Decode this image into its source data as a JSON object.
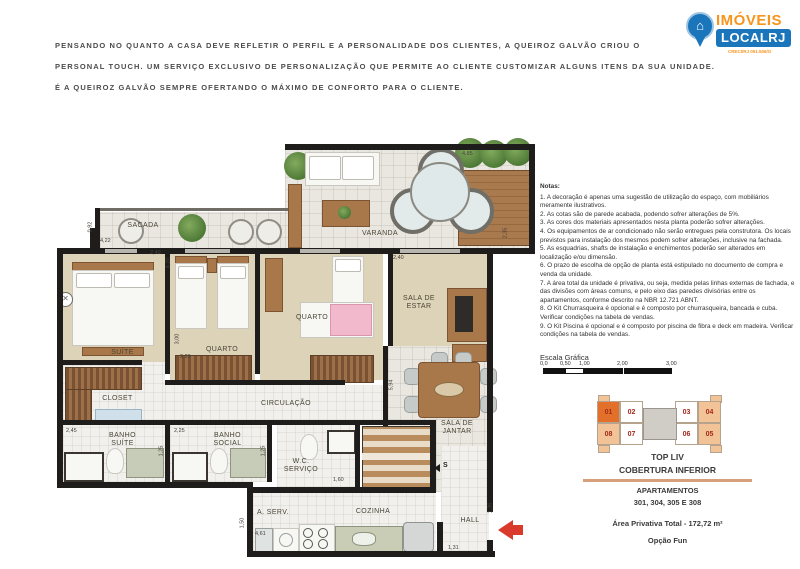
{
  "header": {
    "lines": [
      "PENSANDO NO QUANTO A CASA DEVE REFLETIR O PERFIL E A PERSONALIDADE DOS CLIENTES, A QUEIROZ GALVÃO CRIOU O",
      "PERSONAL TOUCH. UM SERVIÇO EXCLUSIVO DE PERSONALIZAÇÃO QUE PERMITE AO CLIENTE CUSTOMIZAR ALGUNS ITENS DA SUA UNIDADE.",
      "É A QUEIROZ GALVÃO SEMPRE OFERTANDO O MÁXIMO DE CONFORTO PARA O CLIENTE."
    ]
  },
  "logo": {
    "brand_top": "IMÓVEIS",
    "brand_bottom": "LOCALRJ",
    "creci": "CRECI/RJ 051.506/O"
  },
  "colors": {
    "brand_orange": "#F7941E",
    "brand_blue": "#1B75BB",
    "keyplan_highlight": "#E2702A",
    "keyplan_shade": "#F2C396",
    "entry_arrow": "#D93A2B"
  },
  "plan": {
    "rooms": {
      "sacada": "SACADA",
      "varanda": "VARANDA",
      "suite": "SUÍTE",
      "quarto1": "QUARTO",
      "quarto2": "QUARTO",
      "closet": "CLOSET",
      "circulacao": "CIRCULAÇÃO",
      "sala_estar": "SALA DE\nESTAR",
      "sala_jantar": "SALA DE\nJANTAR",
      "banho_suite": "BANHO\nSUÍTE",
      "banho_social": "BANHO\nSOCIAL",
      "wc_servico": "W.C.\nSERVIÇO",
      "a_serv": "A. SERV.",
      "cozinha": "COZINHA",
      "hall": "HALL"
    },
    "stairs_marker": "S",
    "dims": {
      "sacada_w": "4,22",
      "sacada_d": "0,92",
      "suite_w": "2,49",
      "suite_d": "4,20",
      "varanda_w": "4,85",
      "varanda_d": "2,35",
      "estar_w": "2,40",
      "quarto_d": "3,00",
      "quarto_w": "2,29",
      "sala_d": "5,94",
      "banho_suite_w": "2,45",
      "banho_social_w": "2,25",
      "banho_suite_d": "1,25",
      "banho_social_d": "1,25",
      "wc_w": "1,60",
      "aserv_d": "1,50",
      "cozinha_w": "4,61",
      "hall_w": "1,31",
      "hall_d": "1,36"
    }
  },
  "notes": {
    "title": "Notas:",
    "items": [
      "1. A decoração é apenas uma sugestão de utilização do espaço, com mobiliários meramente ilustrativos.",
      "2. As cotas são de parede acabada, podendo sofrer alterações de 5%.",
      "3. As cores dos materiais apresentados nesta planta poderão sofrer alterações.",
      "4. Os equipamentos de ar condicionado não serão entregues pela construtora. Os locais previstos para instalação dos mesmos podem sofrer alterações, inclusive na fachada.",
      "5. As esquadrias, shafts de instalação e enchimentos poderão ser alterados em localização e/ou dimensão.",
      "6. O prazo de escolha de opção de planta está estipulado no documento de compra e venda da unidade.",
      "7. A área total da unidade é privativa, ou seja, medida pelas linhas externas de fachada, e das divisões com áreas comuns, e pelo eixo das paredes divisórias entre os apartamentos, conforme descrito na NBR 12.721 ABNT.",
      "8. O Kit Churrasqueira é opcional e é composto por churrasqueira, bancada e cuba. Verificar condições na tabela de vendas.",
      "9. O Kit Piscina é opcional e é composto por piscina de fibra e deck em madeira. Verificar condições na tabela de vendas."
    ]
  },
  "scale": {
    "title": "Escala Gráfica",
    "ticks": [
      "0,0",
      "0,50",
      "1,00",
      "2,00",
      "3,00"
    ]
  },
  "keyplan": {
    "top_row": [
      "01",
      "02",
      "03",
      "04"
    ],
    "bottom_row": [
      "08",
      "07",
      "06",
      "05"
    ],
    "highlighted_unit": "01",
    "shaded_units": [
      "04",
      "05",
      "08"
    ]
  },
  "unit": {
    "building": "TOP LIV",
    "floor": "COBERTURA INFERIOR",
    "apartments_label": "APARTAMENTOS",
    "apartments": "301, 304, 305 E 308",
    "area": "Área Privativa Total - 172,72 m²",
    "option": "Opção Fun"
  }
}
